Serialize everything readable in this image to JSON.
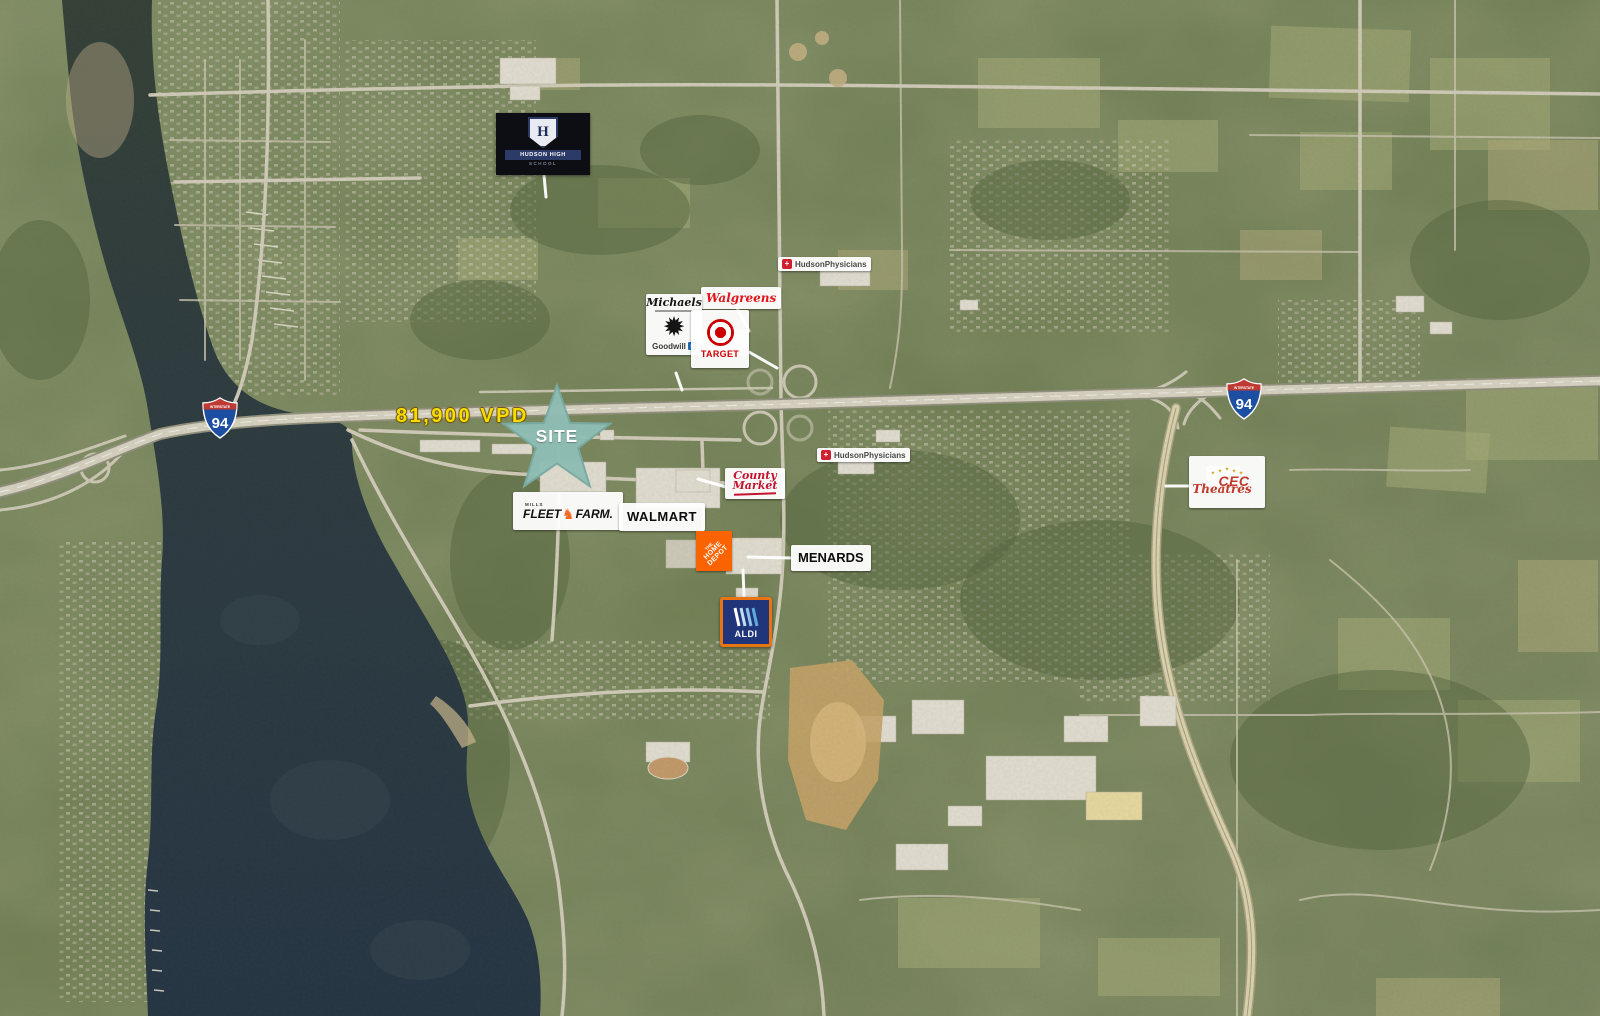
{
  "site": {
    "label": "SITE"
  },
  "traffic": {
    "vpd": "81,900 VPD"
  },
  "interstate": {
    "banner": "INTERSTATE",
    "route": "94"
  },
  "places": {
    "hudson_high_school": {
      "initial": "H",
      "banner": "HUDSON HIGH",
      "subbanner": "SCHOOL"
    },
    "hudson_physicians_north": {
      "name": "HudsonPhysicians"
    },
    "hudson_physicians_south": {
      "name": "HudsonPhysicians"
    },
    "walgreens": {
      "name": "Walgreens"
    },
    "michaels": {
      "name": "Michaels"
    },
    "goodwill": {
      "name": "Goodwill",
      "monogram": "g"
    },
    "target": {
      "name": "TARGET"
    },
    "county_market": {
      "line1": "County",
      "line2": "Market"
    },
    "fleet_farm": {
      "prefix": "MILLS",
      "line1": "FLEET",
      "line2": "FARM."
    },
    "walmart": {
      "name": "WALMART"
    },
    "home_depot": {
      "line1": "THE",
      "line2": "HOME",
      "line3": "DEPOT"
    },
    "menards": {
      "name": "MENARDS"
    },
    "aldi": {
      "name": "ALDI"
    },
    "cec_theatres": {
      "star": "✦",
      "line1": "CEC",
      "line2": "Theatres"
    }
  },
  "icons": {
    "starburst_badge": "✹",
    "horse": "♞",
    "medical_cross": "+"
  },
  "colors": {
    "site_star": "#8fbdb4",
    "traffic_text": "#f6dd00",
    "interstate_blue": "#1c4fa1",
    "interstate_red": "#c03a34",
    "target_red": "#cc0000",
    "walgreens_red": "#e0151c",
    "home_depot_orange": "#f96302",
    "aldi_navy": "#20357a",
    "aldi_orange": "#e87511",
    "county_market_red": "#c41331",
    "fleet_farm_orange": "#f26722",
    "cec_red": "#c0392b",
    "goodwill_blue": "#1f6bb5",
    "water": "#2c3a44"
  }
}
